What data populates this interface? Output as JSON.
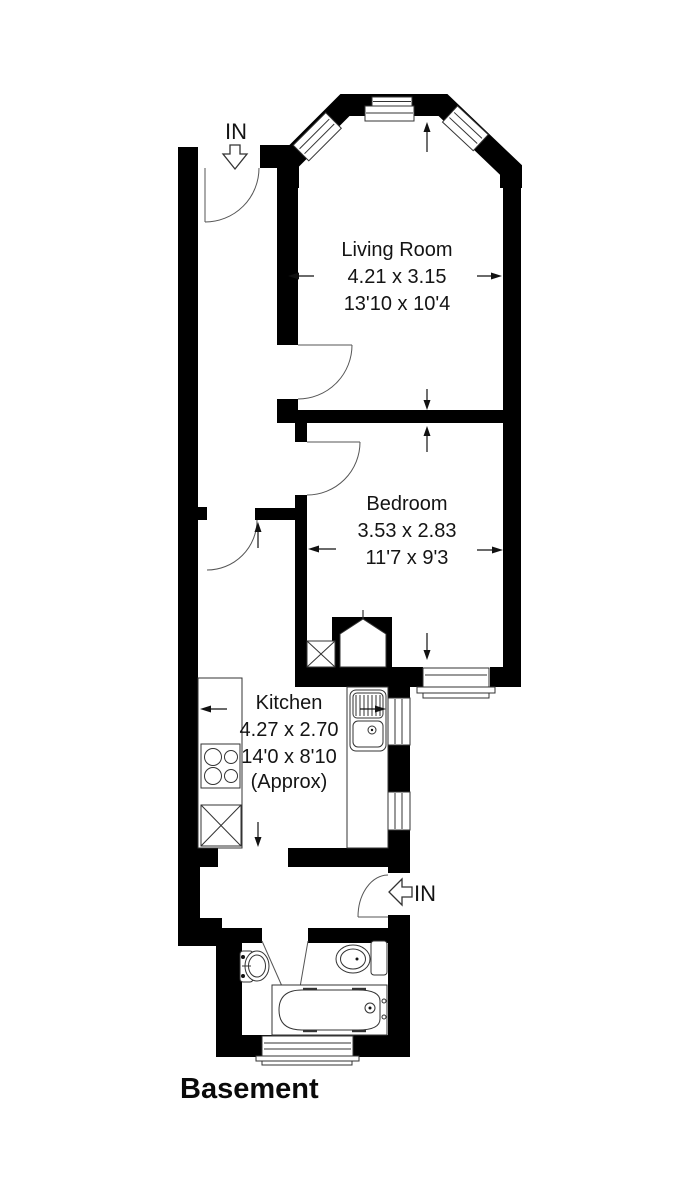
{
  "title": "Basement",
  "rooms": [
    {
      "name": "Living Room",
      "metric": "4.21 x 3.15",
      "imperial": "13'10 x 10'4"
    },
    {
      "name": "Bedroom",
      "metric": "3.53 x 2.83",
      "imperial": "11'7 x 9'3"
    },
    {
      "name": "Kitchen",
      "metric": "4.27 x 2.70",
      "imperial": "14'0 x 8'10",
      "note": "(Approx)"
    }
  ],
  "entrances": [
    {
      "label": "IN",
      "position": "top"
    },
    {
      "label": "IN",
      "position": "right"
    }
  ],
  "colors": {
    "wall": "#000000",
    "line": "#333333",
    "background": "#ffffff"
  }
}
